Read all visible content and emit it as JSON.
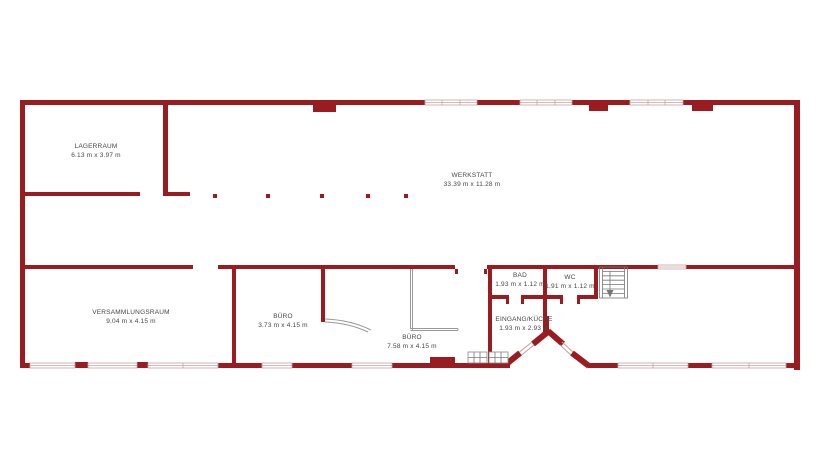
{
  "plan": {
    "type": "architectural-floor-plan",
    "language": "de"
  },
  "rooms": [
    {
      "id": "lagerraum",
      "name": "LAGERRAUM",
      "dims": "6.13 m x 3.97 m"
    },
    {
      "id": "werkstatt",
      "name": "WERKSTATT",
      "dims": "33.39 m x 11.28 m"
    },
    {
      "id": "versammlungsraum",
      "name": "VERSAMMLUNGSRAUM",
      "dims": "9.04 m x 4.15 m"
    },
    {
      "id": "buero-klein",
      "name": "BÜRO",
      "dims": "3.73 m x 4.15 m"
    },
    {
      "id": "buero-gross",
      "name": "BÜRO",
      "dims": "7.58 m x 4.15 m"
    },
    {
      "id": "bad",
      "name": "BAD",
      "dims": "1.93 m x 1.12 m"
    },
    {
      "id": "wc",
      "name": "WC",
      "dims": "1.91 m x 1.12 m"
    },
    {
      "id": "eingang-kueche",
      "name": "EINGANG/KÜCHE",
      "dims": "1.93 m x 2.93 m"
    }
  ],
  "colors": {
    "wall": "#9B1C20",
    "window_outline": "#C9A0A0",
    "glass_partition": "#999999",
    "stairs": "#777777",
    "text": "#454545",
    "background": "#FFFFFF"
  },
  "icons": {
    "stairs": "staircase-with-direction-arrow",
    "door_swing": "door-swing-arc",
    "entrance": "angled-double-door-entrance",
    "kitchen": "kitchen-fixture-grid"
  }
}
